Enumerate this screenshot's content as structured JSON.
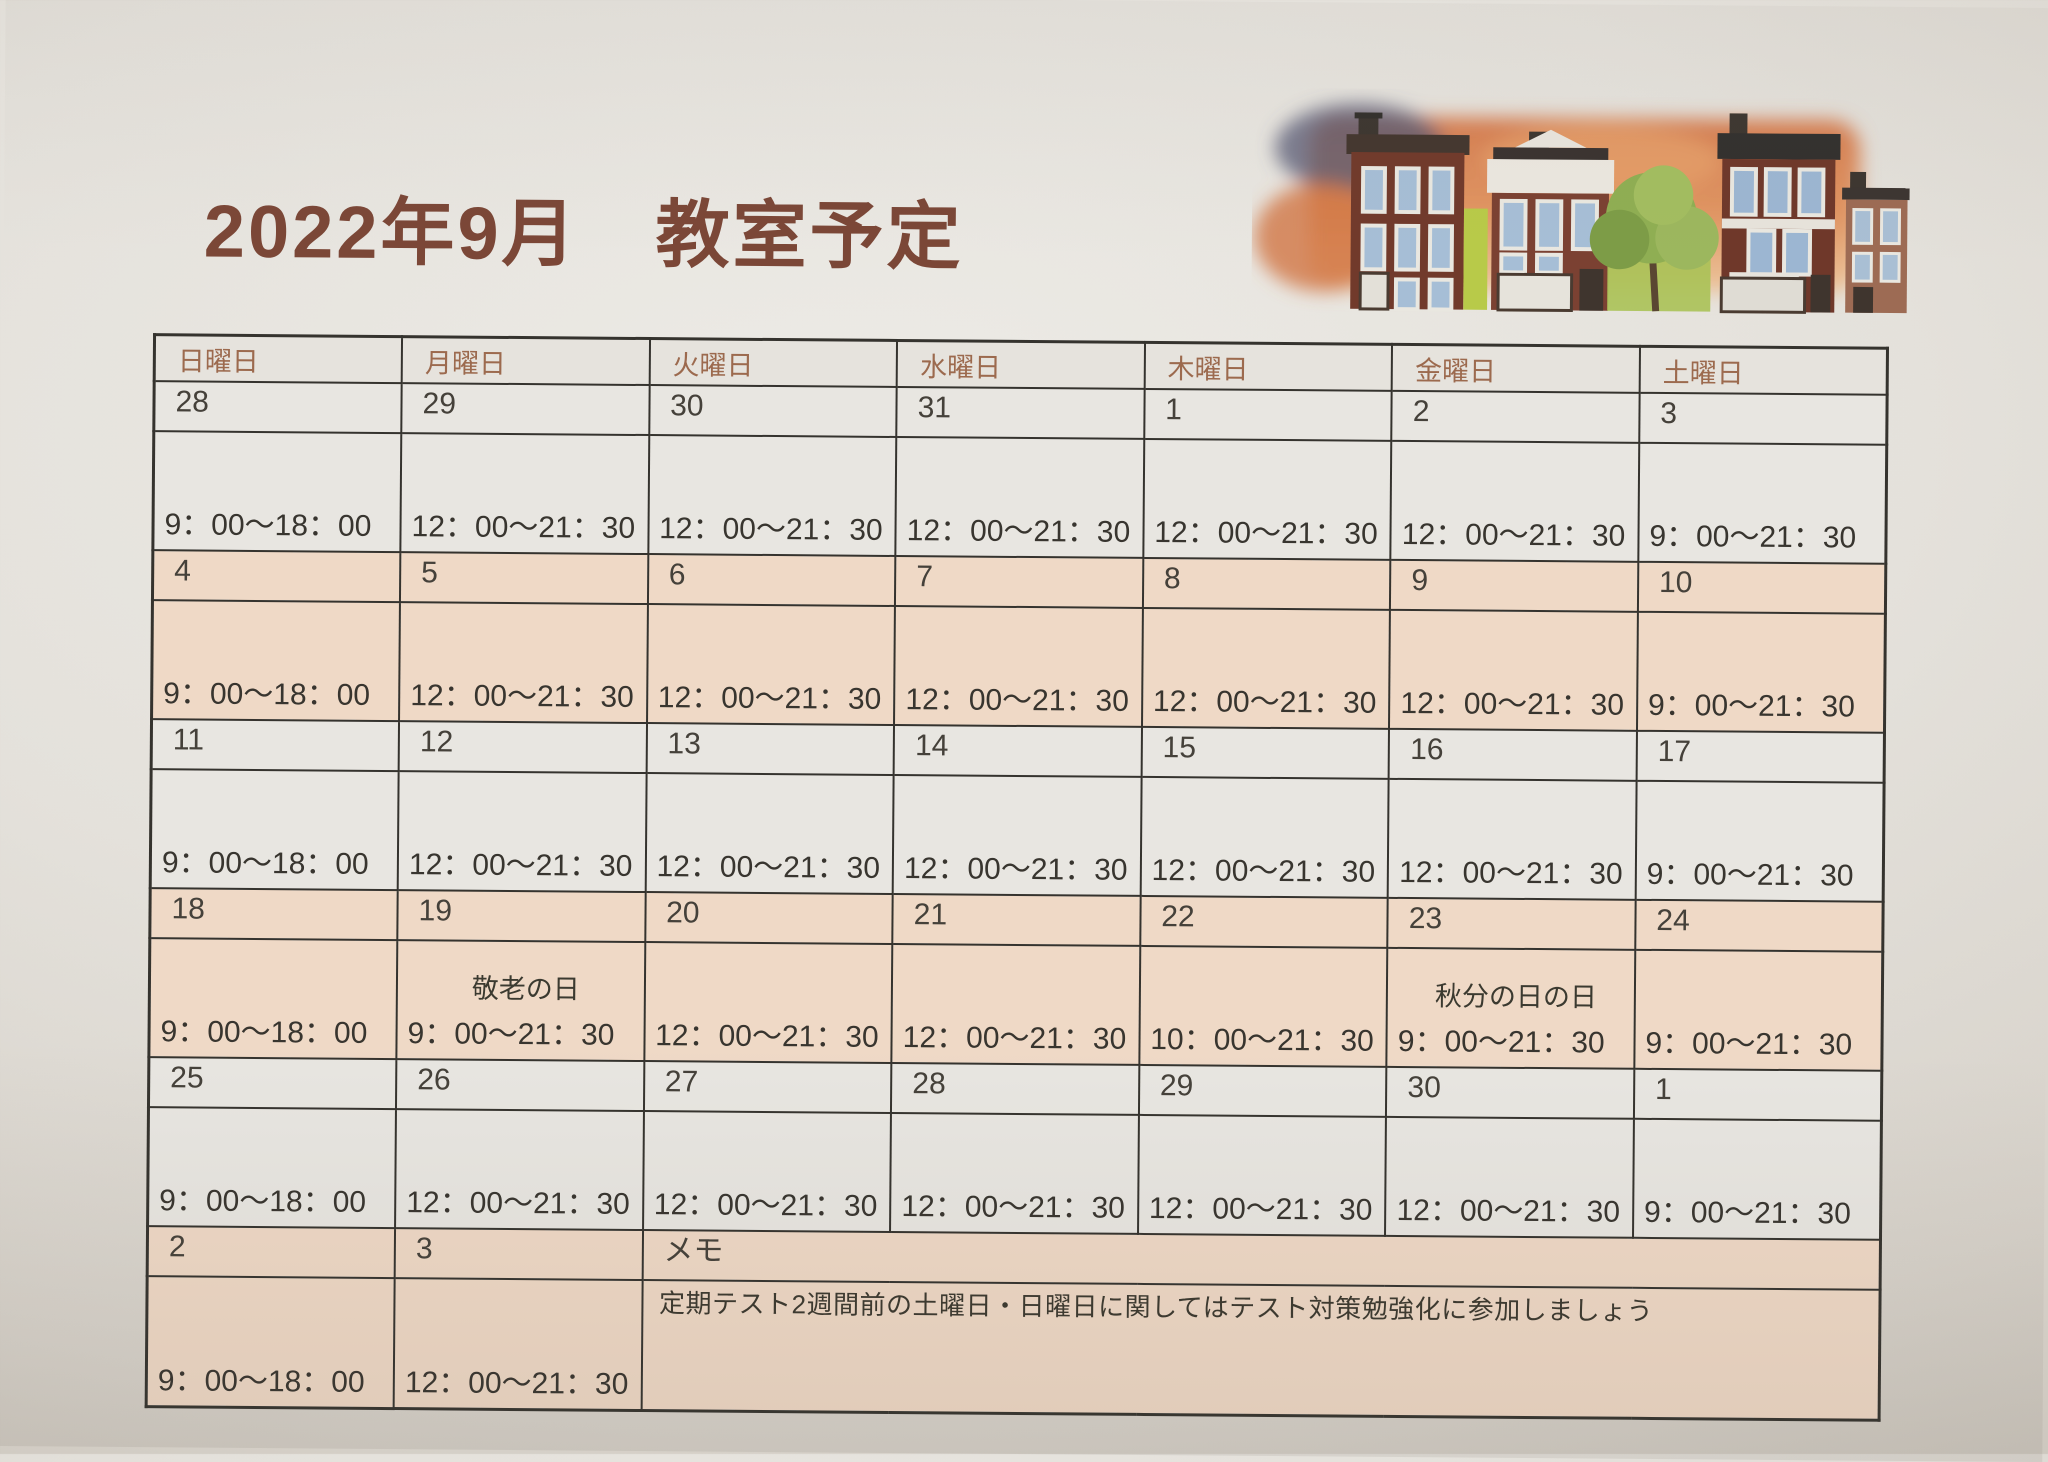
{
  "page": {
    "title": "2022年9月　教室予定",
    "title_color": "#7b4737"
  },
  "colors": {
    "row_gray": "#e8e6e1",
    "row_pink": "#efd9c6",
    "holiday_green": "#7cae4b",
    "header_text": "#9c6a4e",
    "border": "#35332e"
  },
  "illustration": {
    "name": "watercolor-townhouses-sunset"
  },
  "calendar": {
    "day_headers": [
      "日曜日",
      "月曜日",
      "火曜日",
      "水曜日",
      "木曜日",
      "金曜日",
      "土曜日"
    ],
    "weeks": [
      {
        "tone": "gray",
        "days": [
          {
            "date": "28",
            "time": "9：00～18：00"
          },
          {
            "date": "29",
            "time": "12：00～21：30"
          },
          {
            "date": "30",
            "time": "12：00～21：30"
          },
          {
            "date": "31",
            "time": "12：00～21：30"
          },
          {
            "date": "1",
            "time": "12：00～21：30"
          },
          {
            "date": "2",
            "time": "12：00～21：30"
          },
          {
            "date": "3",
            "time": "9：00～21：30"
          }
        ]
      },
      {
        "tone": "pink",
        "days": [
          {
            "date": "4",
            "time": "9：00～18：00"
          },
          {
            "date": "5",
            "time": "12：00～21：30"
          },
          {
            "date": "6",
            "time": "12：00～21：30"
          },
          {
            "date": "7",
            "time": "12：00～21：30"
          },
          {
            "date": "8",
            "time": "12：00～21：30"
          },
          {
            "date": "9",
            "time": "12：00～21：30"
          },
          {
            "date": "10",
            "time": "9：00～21：30"
          }
        ]
      },
      {
        "tone": "gray",
        "days": [
          {
            "date": "11",
            "time": "9：00～18：00"
          },
          {
            "date": "12",
            "time": "12：00～21：30"
          },
          {
            "date": "13",
            "time": "12：00～21：30"
          },
          {
            "date": "14",
            "time": "12：00～21：30"
          },
          {
            "date": "15",
            "time": "12：00～21：30"
          },
          {
            "date": "16",
            "time": "12：00～21：30"
          },
          {
            "date": "17",
            "time": "9：00～21：30"
          }
        ]
      },
      {
        "tone": "pink",
        "days": [
          {
            "date": "18",
            "time": "9：00～18：00"
          },
          {
            "date": "19",
            "holiday": "敬老の日",
            "time": "9：00～21：30"
          },
          {
            "date": "20",
            "time": "12：00～21：30"
          },
          {
            "date": "21",
            "time": "12：00～21：30"
          },
          {
            "date": "22",
            "time": "10：00～21：30"
          },
          {
            "date": "23",
            "holiday": "秋分の日の日",
            "time": "9：00～21：30"
          },
          {
            "date": "24",
            "time": "9：00～21：30"
          }
        ]
      },
      {
        "tone": "gray",
        "days": [
          {
            "date": "25",
            "time": "9：00～18：00"
          },
          {
            "date": "26",
            "time": "12：00～21：30"
          },
          {
            "date": "27",
            "time": "12：00～21：30"
          },
          {
            "date": "28",
            "time": "12：00～21：30"
          },
          {
            "date": "29",
            "time": "12：00～21：30"
          },
          {
            "date": "30",
            "time": "12：00～21：30"
          },
          {
            "date": "1",
            "time": "9：00～21：30"
          }
        ]
      },
      {
        "tone": "pink",
        "days": [
          {
            "date": "2",
            "time": "9：00～18：00"
          },
          {
            "date": "3",
            "time": "12：00～21：30"
          }
        ]
      }
    ],
    "memo": {
      "label": "メモ",
      "note": "定期テスト2週間前の土曜日・日曜日に関してはテスト対策勉強化に参加しましょう"
    }
  }
}
